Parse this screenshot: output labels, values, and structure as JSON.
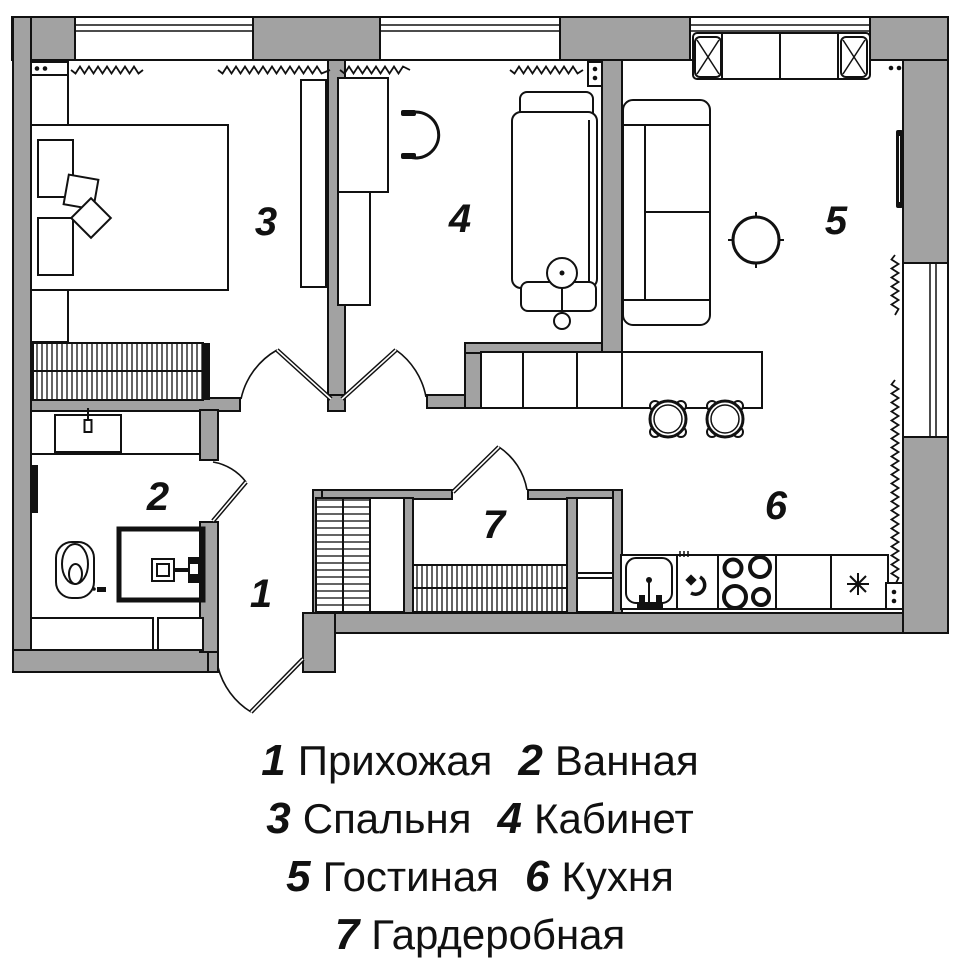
{
  "plan": {
    "labels": {
      "r1": "1",
      "r2": "2",
      "r3": "3",
      "r4": "4",
      "r5": "5",
      "r6": "6",
      "r7": "7"
    }
  },
  "legend": {
    "items": [
      {
        "num": "1",
        "name": "Прихожая"
      },
      {
        "num": "2",
        "name": "Ванная"
      },
      {
        "num": "3",
        "name": "Спальня"
      },
      {
        "num": "4",
        "name": "Кабинет"
      },
      {
        "num": "5",
        "name": "Гостиная"
      },
      {
        "num": "6",
        "name": "Кухня"
      },
      {
        "num": "7",
        "name": "Гардеробная"
      }
    ]
  },
  "colors": {
    "wall": "#a2a2a2",
    "line": "#111111",
    "background": "#ffffff"
  },
  "icons": {
    "furniture": [
      "double-bed",
      "pillow",
      "wardrobe",
      "tall-cabinet",
      "desk",
      "office-chair",
      "daybed",
      "floor-lamp",
      "corner-sofa",
      "sofa-cushion-x",
      "coffee-table",
      "tv",
      "bar-counter",
      "bar-stool",
      "kitchen-counter",
      "kitchen-sink",
      "oven",
      "stove-burners",
      "fridge-asterisk",
      "shelving-unit",
      "hanging-rail",
      "bathroom-sink",
      "mirror",
      "toilet",
      "washing-machine",
      "radiator-zigzag",
      "vent-box",
      "door-swing",
      "window"
    ]
  }
}
